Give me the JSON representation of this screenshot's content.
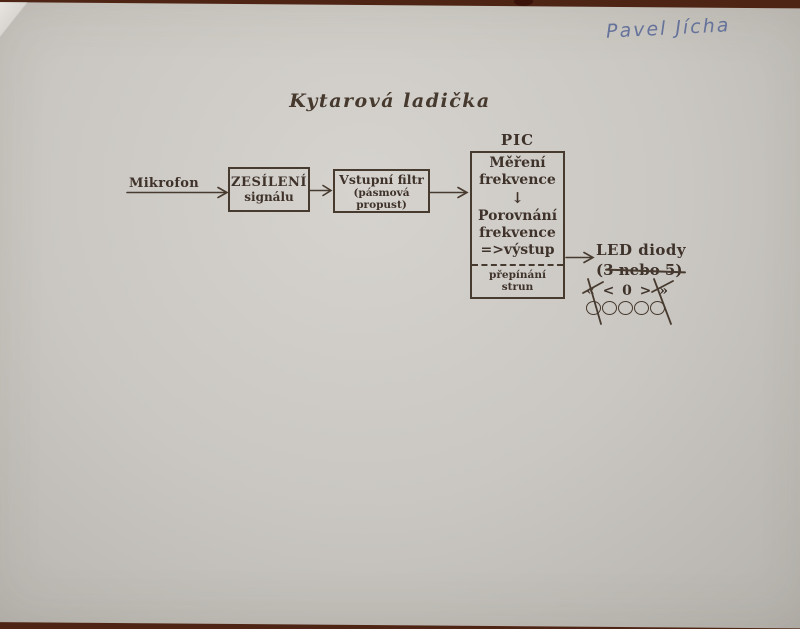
{
  "photo": {
    "handwritten_name": "Pavel Jícha"
  },
  "title": "Kytarová ladička",
  "diagram": {
    "input_label": "Mikrofon",
    "amplifier_box": {
      "line1": "ZESÍLENÍ",
      "line2": "signálu"
    },
    "filter_box": {
      "line1": "Vstupní filtr",
      "line2": "(pásmová propust)"
    },
    "pic_block": {
      "label": "PIC",
      "step1_line1": "Měření",
      "step1_line2": "frekvence",
      "down_arrow": "↓",
      "step2_line1": "Porovnání",
      "step2_line2": "frekvence",
      "step2_line3": "=>výstup",
      "footer": "přepínání strun"
    },
    "output": {
      "line1": "LED diody",
      "count_prefix": "(3 ",
      "count_struck": "nebo 5",
      "count_suffix": ")",
      "indicator_symbols": [
        "«",
        "<",
        "0",
        ">",
        "»"
      ],
      "led_count": 5
    }
  },
  "colors": {
    "ink": "#473a2f",
    "pen_blue": "#556595",
    "paper": "#cac7c2",
    "background": "#4e2414"
  }
}
